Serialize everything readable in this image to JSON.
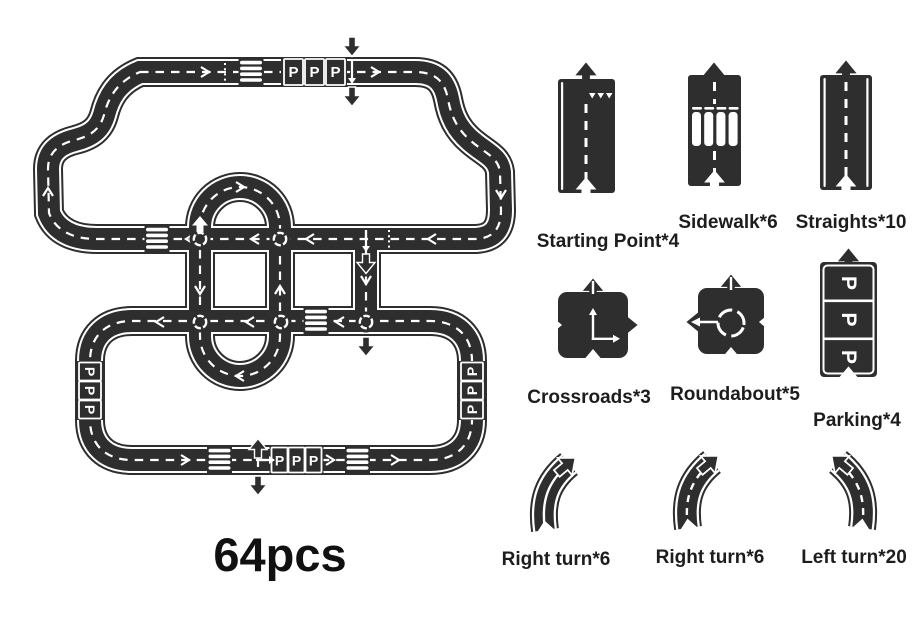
{
  "colors": {
    "road": "#2e2e2e",
    "marking": "#ffffff",
    "text": "#1d1d1d",
    "background": "#ffffff"
  },
  "count_label": "64pcs",
  "track": {
    "parking_letter": "P"
  },
  "legend": {
    "items": [
      {
        "icon": "starting-point-piece",
        "label": "Starting Point*4"
      },
      {
        "icon": "sidewalk-piece",
        "label": "Sidewalk*6"
      },
      {
        "icon": "straight-piece",
        "label": "Straights*10"
      },
      {
        "icon": "crossroads-piece",
        "label": "Crossroads*3"
      },
      {
        "icon": "roundabout-piece",
        "label": "Roundabout*5"
      },
      {
        "icon": "parking-piece",
        "label": "Parking*4"
      },
      {
        "icon": "right-turn-solid-piece",
        "label": "Right turn*6"
      },
      {
        "icon": "right-turn-dashed-piece",
        "label": "Right turn*6"
      },
      {
        "icon": "left-turn-piece",
        "label": "Left turn*20"
      }
    ]
  }
}
